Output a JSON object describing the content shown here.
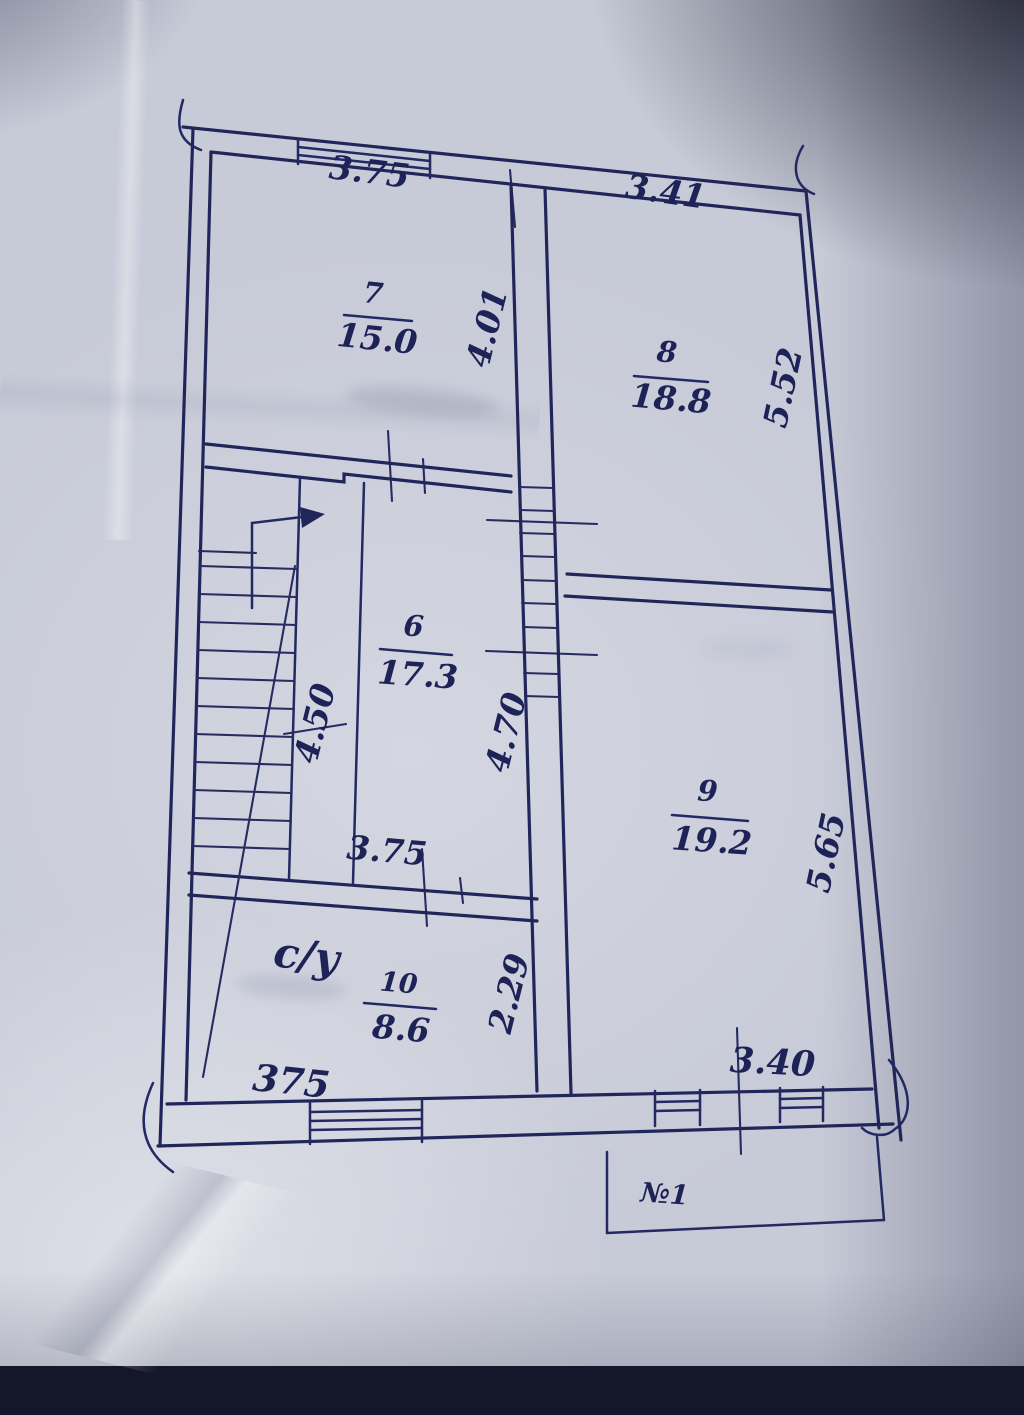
{
  "plan": {
    "rooms": [
      {
        "number": "7",
        "area": "15.0"
      },
      {
        "number": "8",
        "area": "18.8"
      },
      {
        "number": "6",
        "area": "17.3"
      },
      {
        "number": "9",
        "area": "19.2"
      },
      {
        "number": "10",
        "area": "8.6",
        "use_label": "с/у"
      }
    ],
    "dimensions": {
      "top_left": "3.75",
      "top_right": "3.41",
      "room7_depth": "4.01",
      "room8_side": "5.52",
      "stair_side": "4.50",
      "room6_side": "4.70",
      "room9_side": "5.65",
      "room6_bottom": "3.75",
      "room10_side": "2.29",
      "bottom_left": "375",
      "balcony_width": "3.40"
    },
    "balcony_label": "№1"
  },
  "colors": {
    "ink": "#1d2356",
    "paper": "#c7cad7"
  }
}
